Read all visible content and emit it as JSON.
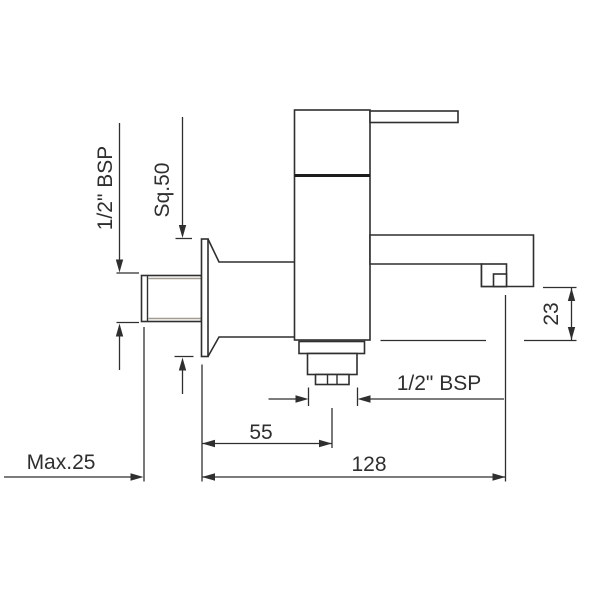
{
  "drawing": {
    "type": "technical-dimension-drawing",
    "subject": "wall-mounted single-lever bath mixer tap, side view",
    "background_color": "#ffffff",
    "line_color": "#2f2f2f",
    "shade_color": "#a39a90"
  },
  "dimensions": {
    "inlet_thread_label": "1/2\" BSP",
    "flange_label": "Sq.50",
    "spout_height_label": "23",
    "outlet_thread_label": "1/2\" BSP",
    "outlet_distance_label": "55",
    "spout_reach_label": "128",
    "wall_thickness_label": "Max.25"
  }
}
